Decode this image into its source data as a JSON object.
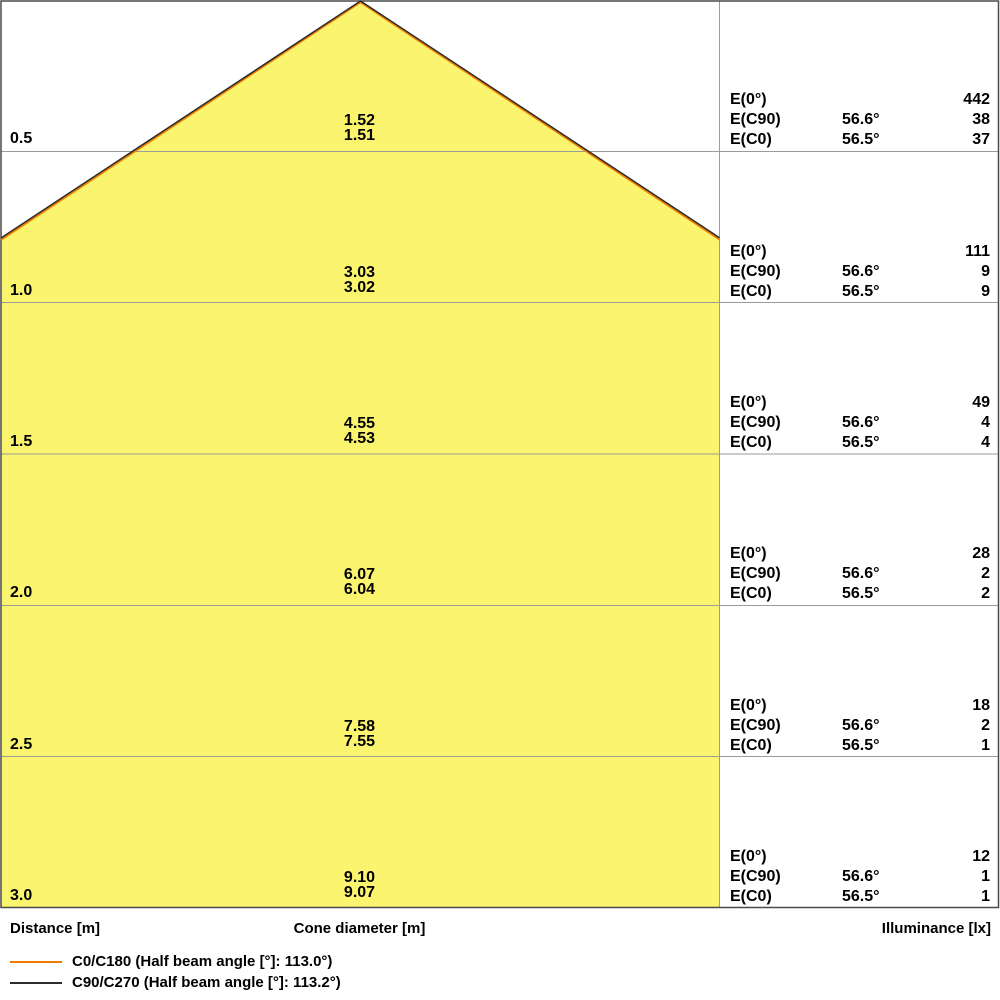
{
  "colors": {
    "cone_fill": "#FAF46E",
    "c0_line": "#EF7D00",
    "c90_line": "#2B2B2B",
    "grid": "#9B9B9B",
    "border": "#4A4A4A"
  },
  "axis": {
    "distance": "Distance [m]",
    "cone_diameter": "Cone diameter [m]",
    "illuminance": "Illuminance [lx]"
  },
  "table_labels": {
    "e0": "E(0°)",
    "ec90": "E(C90)",
    "ec0": "E(C0)"
  },
  "rows": [
    {
      "distance": "0.5",
      "d_c90": "1.52",
      "d_c0": "1.51",
      "e0": "442",
      "ec90_angle": "56.6°",
      "ec90": "38",
      "ec0_angle": "56.5°",
      "ec0": "37"
    },
    {
      "distance": "1.0",
      "d_c90": "3.03",
      "d_c0": "3.02",
      "e0": "111",
      "ec90_angle": "56.6°",
      "ec90": "9",
      "ec0_angle": "56.5°",
      "ec0": "9"
    },
    {
      "distance": "1.5",
      "d_c90": "4.55",
      "d_c0": "4.53",
      "e0": "49",
      "ec90_angle": "56.6°",
      "ec90": "4",
      "ec0_angle": "56.5°",
      "ec0": "4"
    },
    {
      "distance": "2.0",
      "d_c90": "6.07",
      "d_c0": "6.04",
      "e0": "28",
      "ec90_angle": "56.6°",
      "ec90": "2",
      "ec0_angle": "56.5°",
      "ec0": "2"
    },
    {
      "distance": "2.5",
      "d_c90": "7.58",
      "d_c0": "7.55",
      "e0": "18",
      "ec90_angle": "56.6°",
      "ec90": "2",
      "ec0_angle": "56.5°",
      "ec0": "1"
    },
    {
      "distance": "3.0",
      "d_c90": "9.10",
      "d_c0": "9.07",
      "e0": "12",
      "ec90_angle": "56.6°",
      "ec90": "1",
      "ec0_angle": "56.5°",
      "ec0": "1"
    }
  ],
  "legend": {
    "items": [
      {
        "label": "C0/C180 (Half beam angle [°]: 113.0°)",
        "color": "#EF7D00"
      },
      {
        "label": "C90/C270 (Half beam angle [°]: 113.2°)",
        "color": "#2B2B2B"
      }
    ]
  },
  "chart_data": {
    "type": "table",
    "title": "Light cone diagram",
    "columns": [
      "Distance [m]",
      "Cone diameter C90/C270 [m]",
      "Cone diameter C0/C180 [m]",
      "E(0°) [lx]",
      "E(C90) half beam angle",
      "E(C90) [lx]",
      "E(C0) half beam angle",
      "E(C0) [lx]"
    ],
    "rows": [
      [
        0.5,
        1.52,
        1.51,
        442,
        "56.6°",
        38,
        "56.5°",
        37
      ],
      [
        1.0,
        3.03,
        3.02,
        111,
        "56.6°",
        9,
        "56.5°",
        9
      ],
      [
        1.5,
        4.55,
        4.53,
        49,
        "56.6°",
        4,
        "56.5°",
        4
      ],
      [
        2.0,
        6.07,
        6.04,
        28,
        "56.6°",
        2,
        "56.5°",
        2
      ],
      [
        2.5,
        7.58,
        7.55,
        18,
        "56.6°",
        2,
        "56.5°",
        1
      ],
      [
        3.0,
        9.1,
        9.07,
        12,
        "56.6°",
        1,
        "56.5°",
        1
      ]
    ],
    "half_beam_angles": {
      "C0/C180": "113.0°",
      "C90/C270": "113.2°"
    },
    "cone": {
      "apex_distance_m": 0,
      "max_distance_m": 3.0,
      "distance_step_m": 0.5,
      "drawn_to_scale_px_per_m": 302.7,
      "apex_x_px": 360.5,
      "cone_area_width_px": 720
    },
    "legend_position": "bottom-left",
    "grid": true
  }
}
